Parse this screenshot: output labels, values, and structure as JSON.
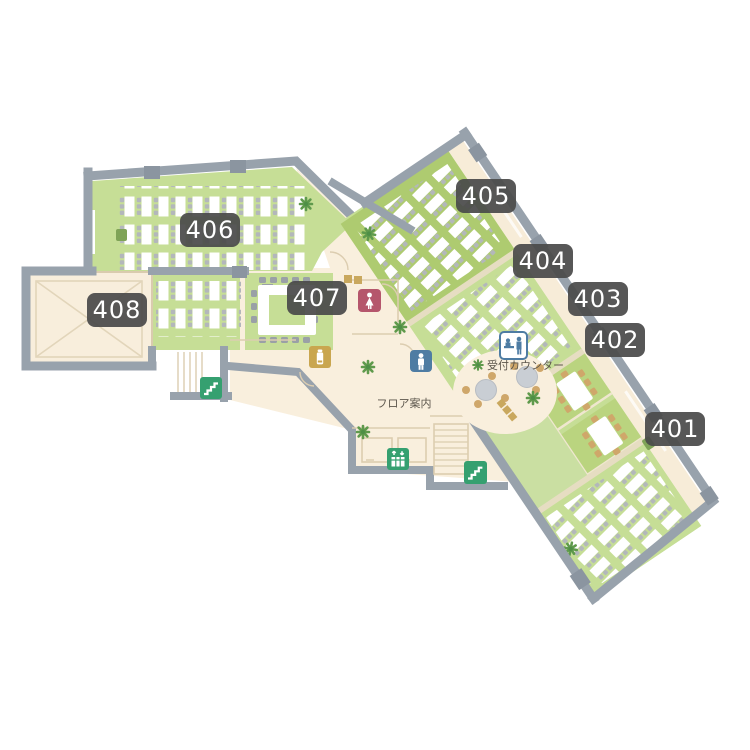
{
  "map_type": "floor-guide-map",
  "rooms": [
    {
      "id": "401",
      "label": "401",
      "kind": "large seminar room with desk rows"
    },
    {
      "id": "402",
      "label": "402",
      "kind": "small meeting room with table"
    },
    {
      "id": "403",
      "label": "403",
      "kind": "small meeting room with table"
    },
    {
      "id": "404",
      "label": "404",
      "kind": "seminar room with desk rows"
    },
    {
      "id": "405",
      "label": "405",
      "kind": "seminar room with desk rows"
    },
    {
      "id": "406",
      "label": "406",
      "kind": "large seminar room with desk rows"
    },
    {
      "id": "407",
      "label": "407",
      "kind": "conference room with boardroom table"
    },
    {
      "id": "408",
      "label": "408",
      "kind": "multipurpose hall"
    }
  ],
  "texts": {
    "reception_counter": "受付カウンター",
    "floor_guide": "フロア案内"
  },
  "facilities": [
    {
      "name": "reception-counter-icon"
    },
    {
      "name": "female-restroom-icon"
    },
    {
      "name": "male-restroom-icon"
    },
    {
      "name": "elevator-icon"
    },
    {
      "name": "stairs-icon-west"
    },
    {
      "name": "stairs-icon-center"
    },
    {
      "name": "vending-machine-icon"
    }
  ],
  "colors": {
    "bg": "#ffffff",
    "wall": "#98a2ac",
    "pier": "#8b95a0",
    "cream": "#f9efdd",
    "cream2": "#f7ecd8",
    "green": "#c6de96",
    "greendark": "#aecb70",
    "greenmid": "#bad47f",
    "greencorr": "#cadfa2",
    "linetan": "#dccdb0",
    "tan": "#cfa76a",
    "gold": "#c9a64f",
    "labelbg": "#4a4a4a",
    "textdark": "#5c564c",
    "iconfemale": "#b5566c",
    "iconmale": "#4e7ca3",
    "icongreen": "#35a070",
    "plant": "#5f9a4c",
    "deskchair": "#b3b7bb",
    "tablegray": "#c9ced4"
  }
}
